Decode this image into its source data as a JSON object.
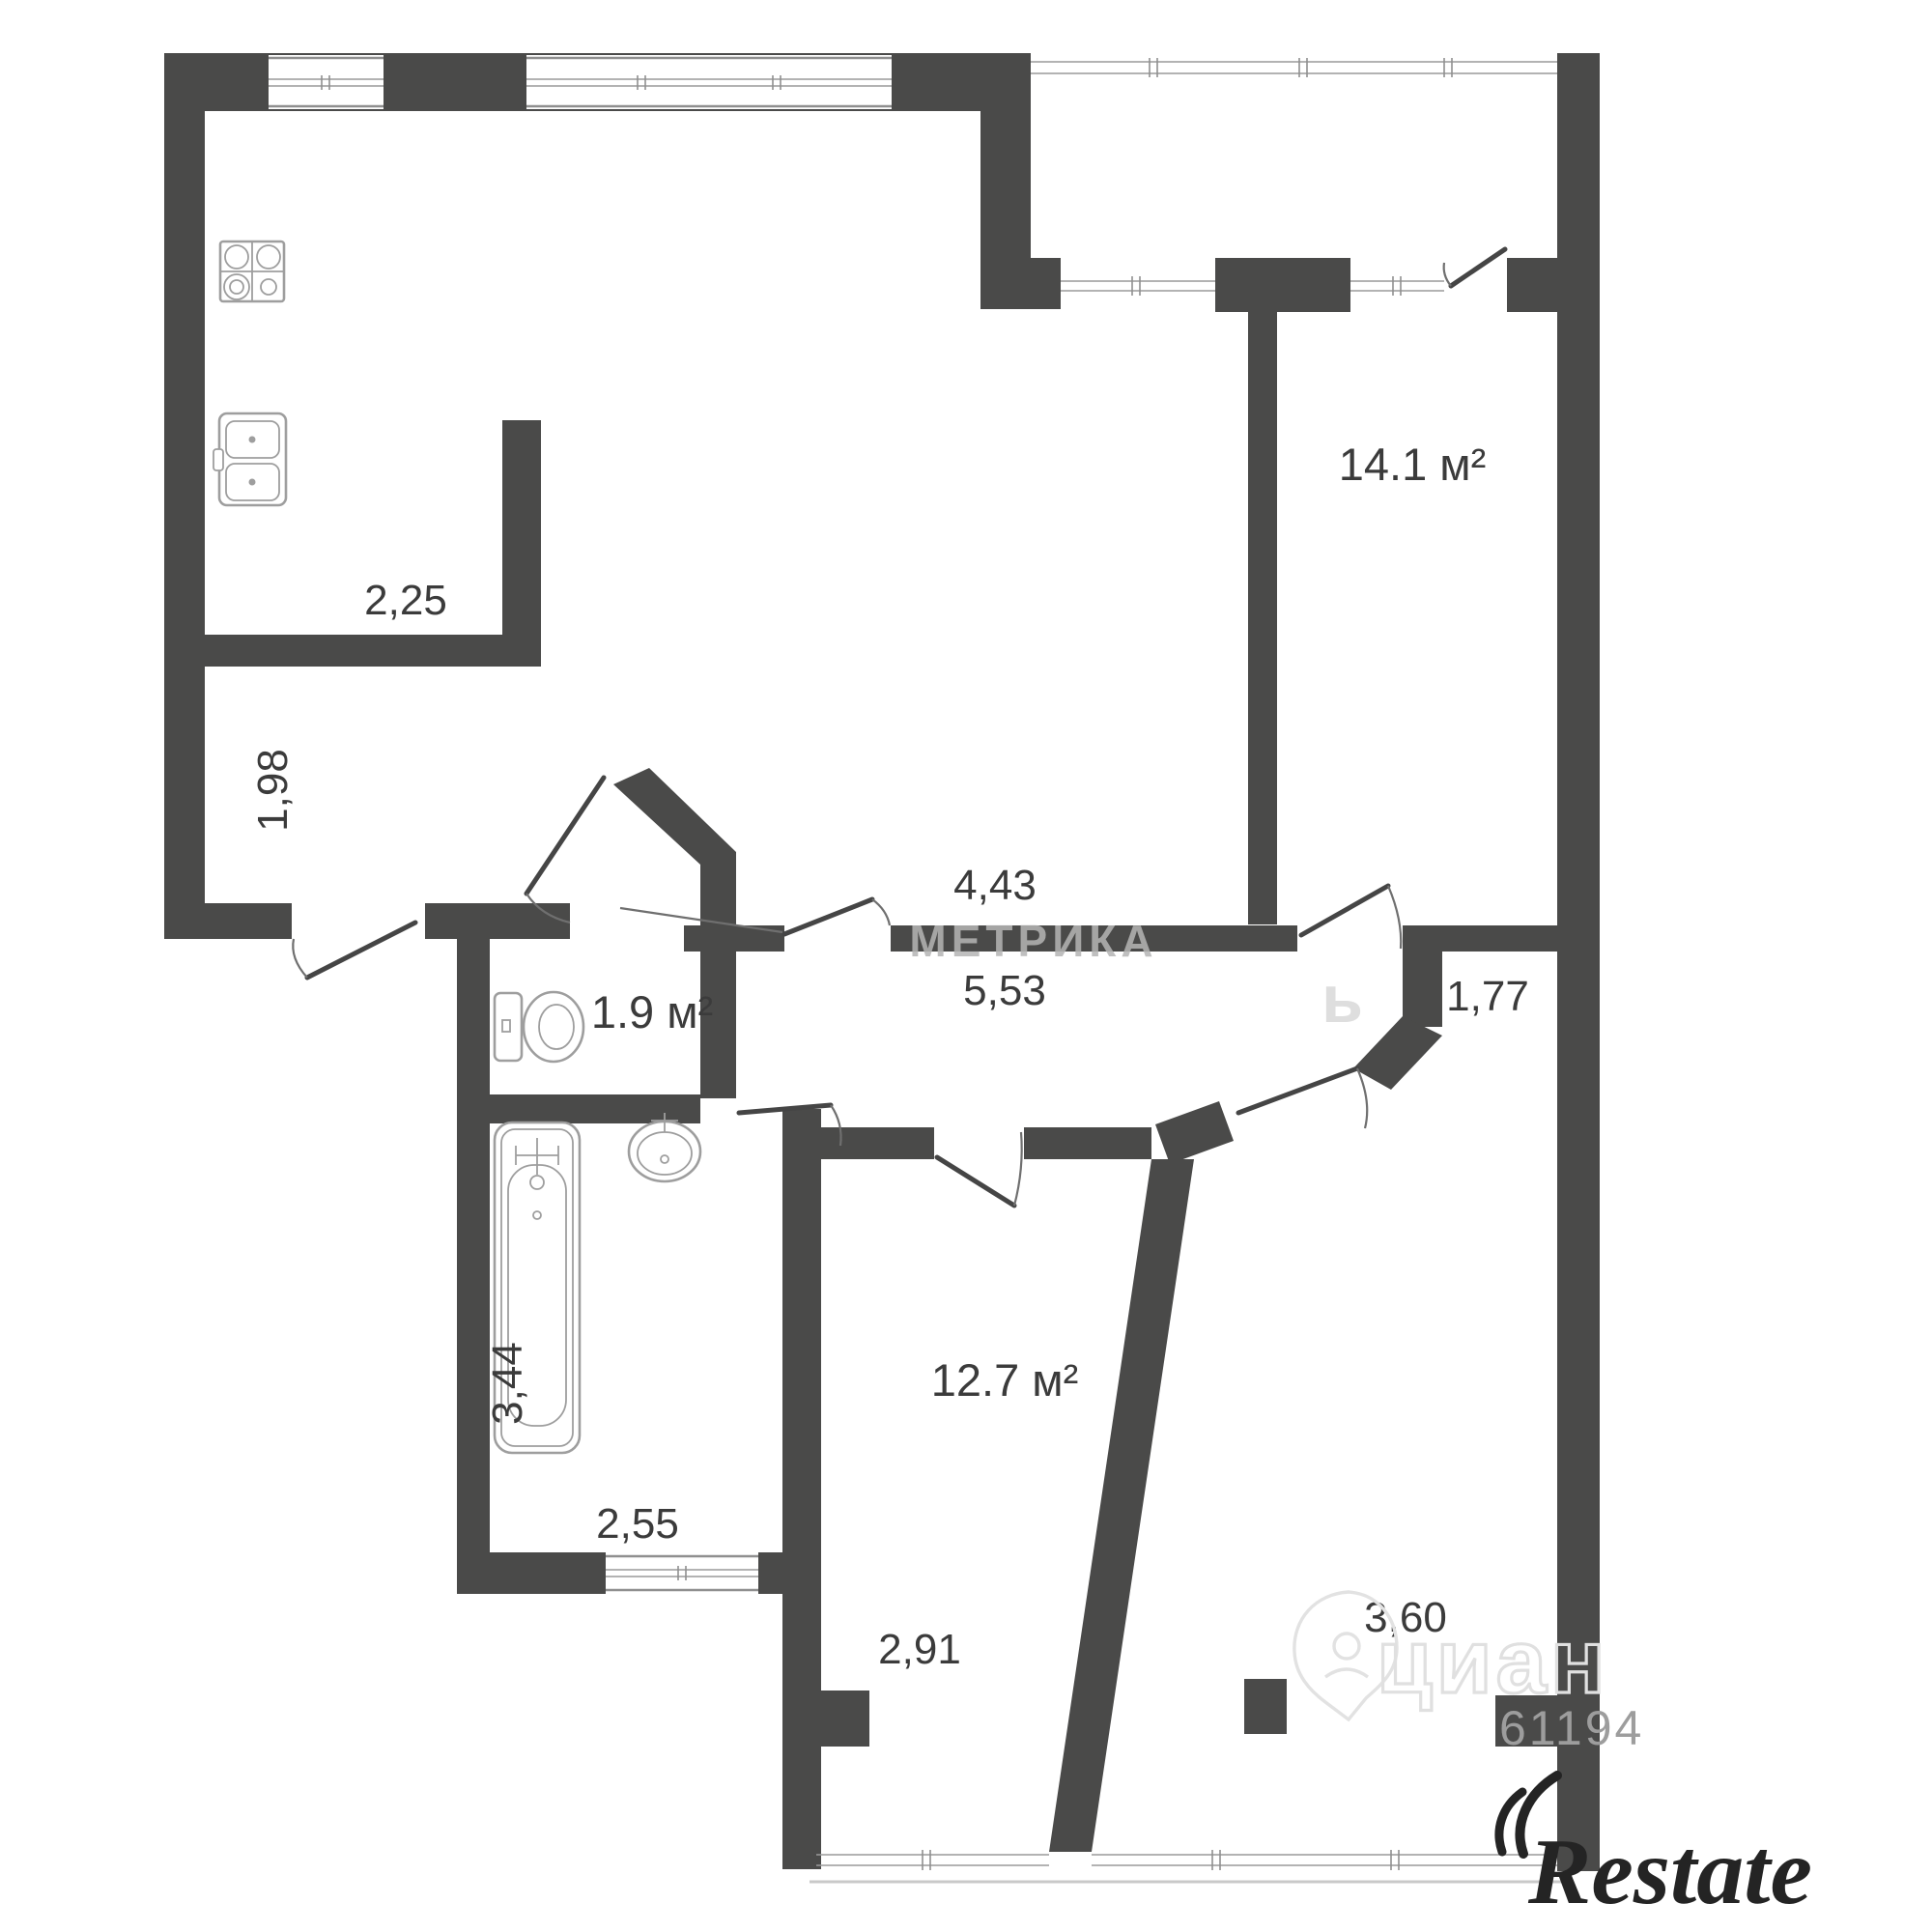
{
  "plan": {
    "type": "apartment floor plan",
    "wall_color": "#4a4a49",
    "label_color": "#3b3b3b",
    "watermark_color": "#dedede"
  },
  "rooms": [
    {
      "id": "room-14-1",
      "area_label": "14.1 м²"
    },
    {
      "id": "wc",
      "area_label": "1.9 м²"
    },
    {
      "id": "room-12-7",
      "area_label": "12.7 м²"
    }
  ],
  "dimensions": {
    "kitchen_width": "2,25",
    "kitchen_depth": "1,98",
    "hall_width": "4,43",
    "hall_length": "5,53",
    "corridor_depth": "1,77",
    "bathroom_depth": "3,44",
    "bathroom_width": "2,55",
    "room_12_7_width": "2,91",
    "room_3_60_width": "3,60"
  },
  "watermarks": {
    "metrika": "МЕТРИКА",
    "soft_letter": "ь",
    "cian": "циан",
    "digits": "61194",
    "restate": "Restate"
  }
}
